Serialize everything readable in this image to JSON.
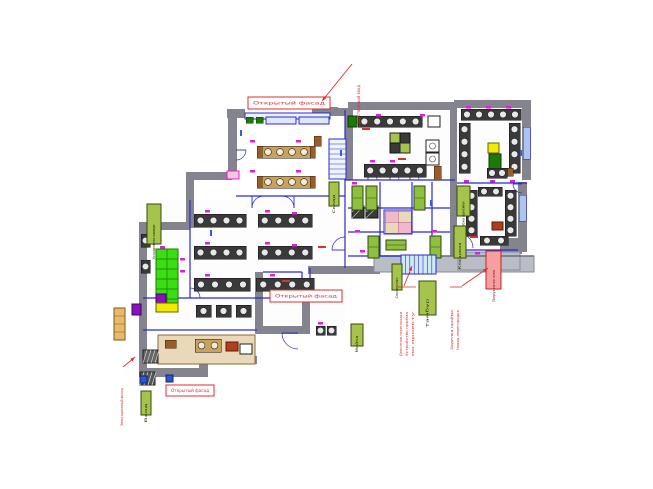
{
  "drawing": {
    "type": "floor-plan",
    "background": "#ffffff",
    "palette": {
      "wall_gray": "#84848f",
      "wall_gray_light": "#b9bec6",
      "partition_blue": "#2a2ad0",
      "glazing_blue": "#aac4f4",
      "accent_magenta": "#e020d8",
      "rack_green": "#3ade12",
      "rack_green_dark": "#1d7a08",
      "note_olive": "#a6c34c",
      "note_olive_text": "#1d2d08",
      "red": "#d93030",
      "pink_note_fill": "#f4a0a0",
      "stair_cyan": "#cfeaf5",
      "counter_tan": "#ead9b8",
      "wood_brown": "#9a5c28",
      "yellow": "#f2ea00",
      "purple": "#8a10c0",
      "fixture_dark": "#3a3a3a",
      "fixture_circle": "#e8e8e8"
    },
    "facade_labels": [
      {
        "id": "facade-top",
        "text": "Открытый фасад"
      },
      {
        "id": "facade-middle",
        "text": "Открытый фасад"
      },
      {
        "id": "facade-bottom",
        "text": "Открытый фасад"
      }
    ],
    "red_notes": [
      {
        "id": "red-top",
        "text": "Существующий вход"
      },
      {
        "id": "red-left",
        "text": "Эвакуационный выход"
      },
      {
        "id": "red-b1",
        "text": "Демонтаж перегородки"
      },
      {
        "id": "red-b2",
        "text": "Устройство проёма"
      },
      {
        "id": "red-b3",
        "text": "по проекту"
      },
      {
        "id": "red-b4",
        "text": "Заделка проёма"
      },
      {
        "id": "red-b5",
        "text": "Новая перегородка"
      }
    ],
    "pink_note": {
      "id": "pink-note",
      "text": "Погрузочная зона"
    },
    "green_notes": [
      {
        "id": "gn-1",
        "text": "Холодильная камера"
      },
      {
        "id": "gn-2",
        "text": "Зона приёмки"
      },
      {
        "id": "gn-3",
        "text": "Кладовая"
      },
      {
        "id": "gn-4",
        "text": "Серверная"
      },
      {
        "id": "gn-5",
        "text": "Тамбур"
      },
      {
        "id": "gn-6",
        "text": "Мойка"
      },
      {
        "id": "gn-7",
        "text": "Склад"
      },
      {
        "id": "gn-8",
        "text": "Вход"
      }
    ]
  }
}
